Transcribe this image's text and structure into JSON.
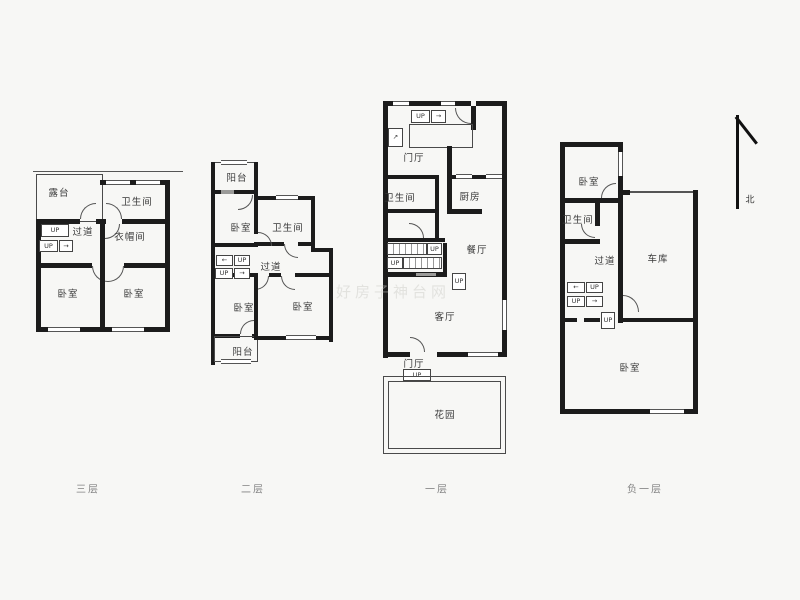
{
  "floors": [
    {
      "caption": "三层",
      "rooms": {
        "terrace": "露台",
        "bathroom": "卫生间",
        "corridor": "过道",
        "cloakroom": "衣帽间",
        "bedroom_left": "卧室",
        "bedroom_right": "卧室"
      }
    },
    {
      "caption": "二层",
      "rooms": {
        "balcony_top": "阳台",
        "bedroom_top": "卧室",
        "bathroom": "卫生间",
        "corridor": "过道",
        "bedroom_left": "卧室",
        "bedroom_right": "卧室",
        "balcony_bottom": "阳台"
      }
    },
    {
      "caption": "一层",
      "rooms": {
        "foyer_top": "门厅",
        "bathroom": "卫生间",
        "kitchen": "厨房",
        "dining": "餐厅",
        "living": "客厅",
        "foyer_bottom": "门厅",
        "garden": "花园"
      }
    },
    {
      "caption": "负一层",
      "rooms": {
        "bedroom_top": "卧室",
        "bathroom": "卫生间",
        "corridor": "过道",
        "garage": "车库",
        "bedroom_main": "卧室"
      }
    }
  ],
  "stairs": {
    "up_label": "UP",
    "arrow_right": "→",
    "arrow_left": "←",
    "arrow_up": "↑",
    "arrow_diag": "↗"
  },
  "compass": {
    "north_label": "北"
  },
  "watermark": "好房子神台网",
  "colors": {
    "wall": "#1c1c1c",
    "background": "#f7f7f5",
    "label": "#3a3a3a",
    "caption": "#828282"
  }
}
